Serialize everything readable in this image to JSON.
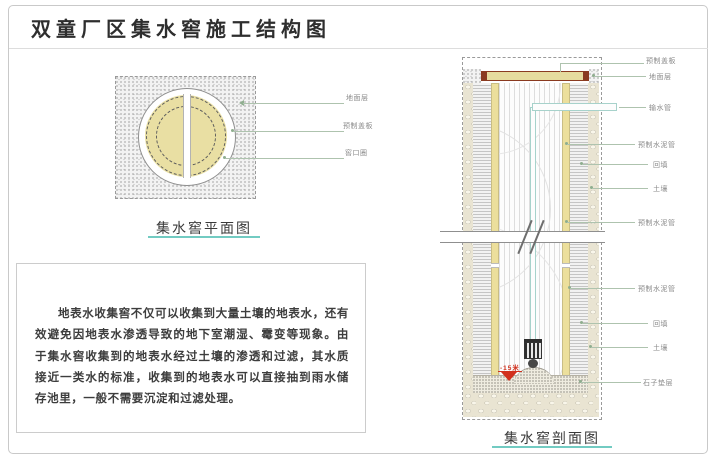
{
  "title": "双童厂区集水窖施工结构图",
  "plan": {
    "caption": "集水窖平面图",
    "labels": [
      "地面层",
      "预制盖板",
      "窖口圈"
    ]
  },
  "section": {
    "caption": "集水窖剖面图",
    "labels": [
      "预制盖板",
      "地面层",
      "输水管",
      "预制水泥管",
      "回填",
      "土壤",
      "预制水泥管",
      "预制水泥管",
      "回填",
      "土壤",
      "石子垫层"
    ],
    "depth_marker": "-15米"
  },
  "description": "地表水收集窖不仅可以收集到大量土壤的地表水，还有效避免因地表水渗透导致的地下室潮湿、霉变等现象。由于集水窖收集到的地表水经过土壤的渗透和过滤，其水质接近一类水的标准，收集到的地表水可以直接抽到雨水储存池里，一般不需要沉淀和过滤处理。",
  "colors": {
    "accent_teal": "#72cbc2",
    "tan_fill": "#e9dfa3",
    "cover_red": "#8a3a20",
    "leader_green": "#aec3ae",
    "depth_red": "#d2311e"
  }
}
